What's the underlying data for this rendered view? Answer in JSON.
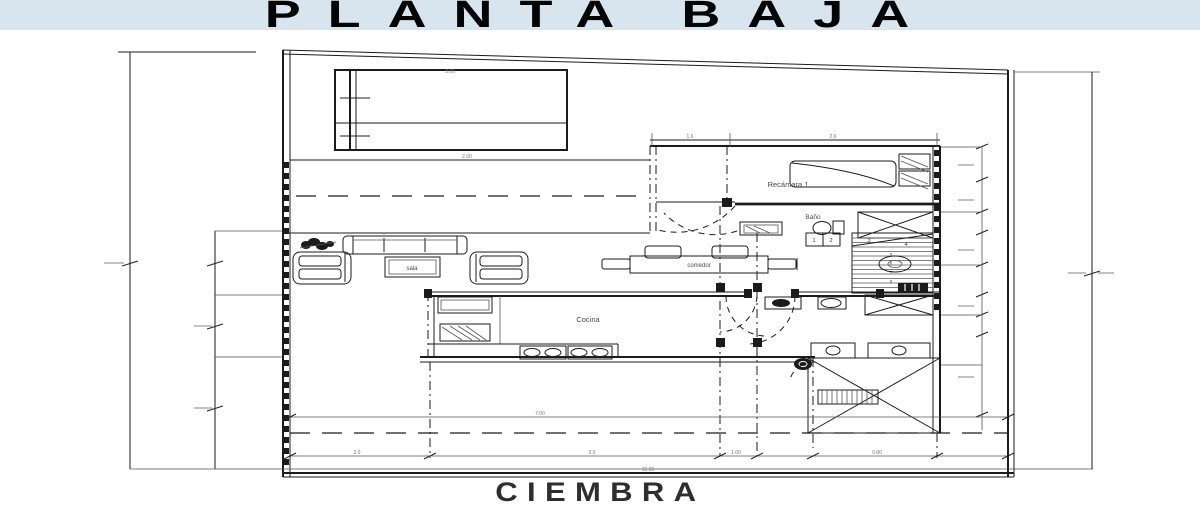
{
  "title": "PLANTA BAJA",
  "footer": "CIEMBRA",
  "colors": {
    "title_bg": "#d8e5ee",
    "ink": "#1b1b1b",
    "dim_text": "#777777"
  },
  "rooms": {
    "recamara1": "Recámara 1",
    "bano": "Baño",
    "cocina": "Cocina",
    "comedor": "comedor",
    "sala": "sala"
  },
  "stairs": {
    "steps": [
      "1",
      "2",
      "3",
      "4",
      "5",
      "6",
      "7",
      "8"
    ]
  },
  "dims": {
    "carport_w": "3.00",
    "drive_w": "2.00",
    "span_mid": "7.00",
    "lot_w": "15.00",
    "seg_a": "2.0",
    "seg_b": "3.0",
    "seg_c": "1.00",
    "seg_d": "0.80",
    "bed_a": "1.6",
    "bed_b": "2.6"
  }
}
